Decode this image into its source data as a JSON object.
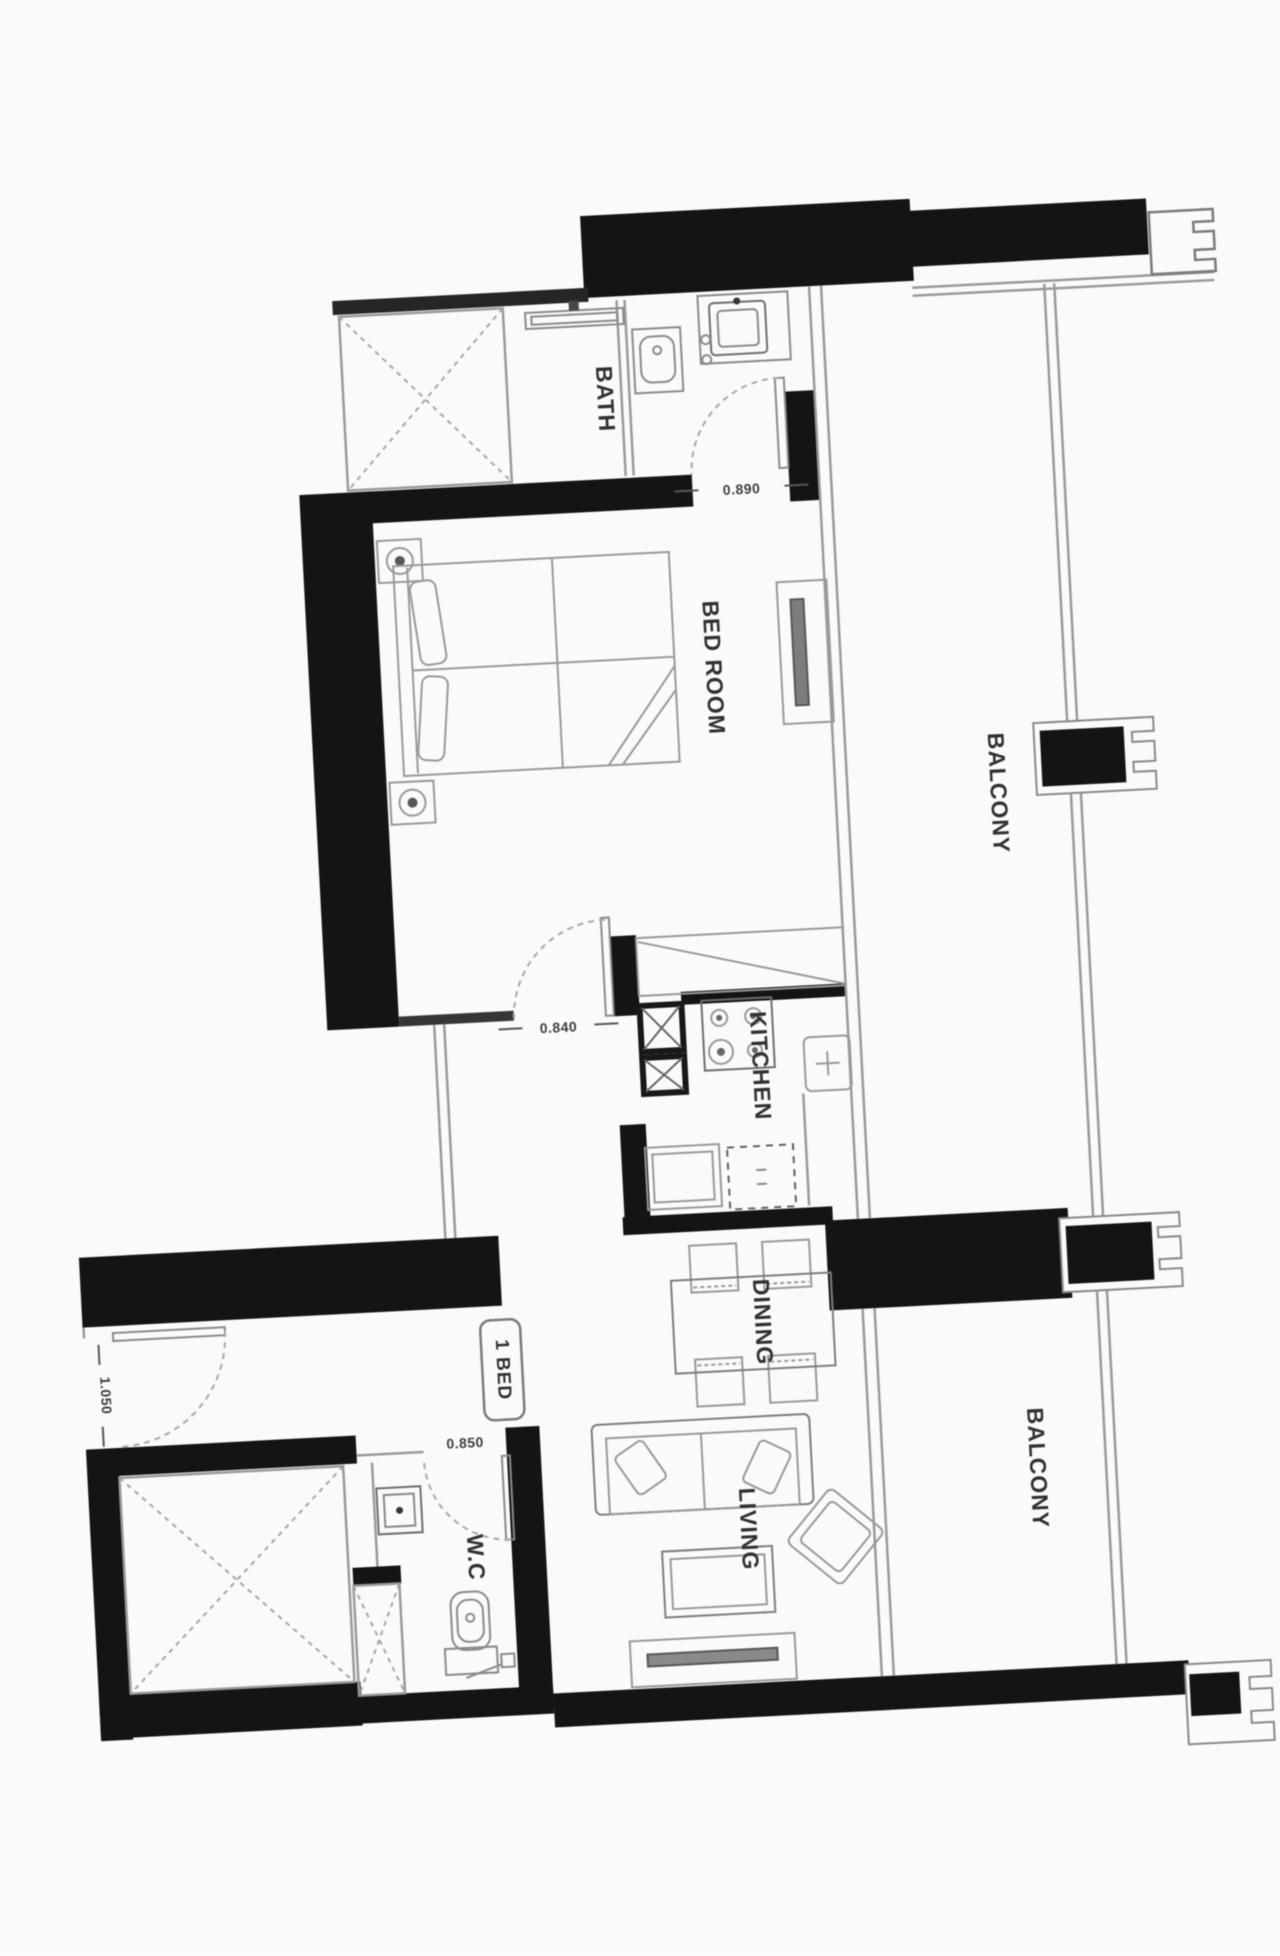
{
  "title": "1 BED apartment floor plan",
  "colors": {
    "wall": "#101010",
    "line": "#9b9b9b",
    "line_dark": "#6e6e6e",
    "text": "#2e2e2e",
    "dim_text": "#3c3c3c",
    "background": "#ffffff"
  },
  "rooms": {
    "bath": {
      "label": "BATH"
    },
    "bedroom": {
      "label": "BED ROOM"
    },
    "kitchen": {
      "label": "KITCHEN"
    },
    "dining": {
      "label": "DINING"
    },
    "living": {
      "label": "LIVING"
    },
    "wc": {
      "label": "W.C"
    },
    "balcony_upper": {
      "label": "BALCONY"
    },
    "balcony_lower": {
      "label": "BALCONY"
    }
  },
  "unit": {
    "type_badge": "1 BED"
  },
  "dimensions": {
    "bath_door": "0.890",
    "bedroom_door": "0.840",
    "entrance_door": "1.050",
    "wc_door": "0.850"
  }
}
